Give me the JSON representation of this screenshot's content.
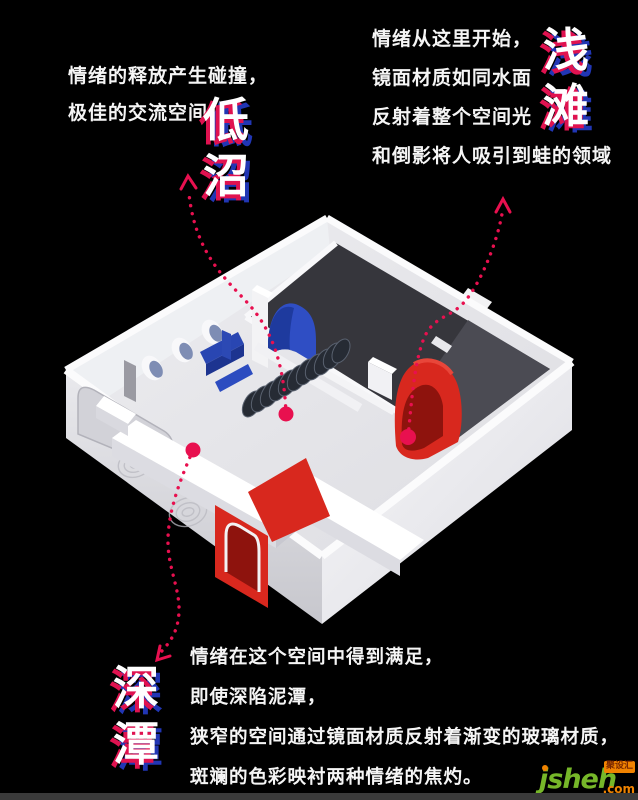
{
  "background": "#000000",
  "accent": {
    "arrow_pink": "#e8104f",
    "glitch_shadow_red": "#e01250",
    "glitch_shadow_blue": "#2136b4"
  },
  "annotations": {
    "top_left": {
      "lines": [
        "情绪的释放产生碰撞，",
        "极佳的交流空间"
      ],
      "label": "低沼"
    },
    "top_right": {
      "lines": [
        "情绪从这里开始，",
        "镜面材质如同水面",
        "反射着整个空间光",
        "和倒影将人吸引到蛙的领域"
      ],
      "label": "浅滩"
    },
    "bottom": {
      "lines": [
        "情绪在这个空间中得到满足，",
        "即使深陷泥潭，",
        "狭窄的空间通过镜面材质反射着渐变的玻璃材质，",
        "斑斓的色彩映衬两种情绪的焦灼。"
      ],
      "label": "深潭"
    }
  },
  "model": {
    "palette": {
      "wall": "#f2f2f4",
      "wall_shade": "#d8d8dd",
      "back_wall": "#ededf1",
      "floor": "#e6e6ea",
      "dark_wall": "#36363c",
      "dark_wall_light": "#4b4b53",
      "blue": "#2f4ec4",
      "blue_dark": "#1e3a9e",
      "red": "#d8281e",
      "red_dark": "#8e130d",
      "coil": "#262b34",
      "rim": "#fafafb"
    }
  },
  "watermark": {
    "brand": "jsheh",
    "suffix": ".com",
    "badge": "聚设汇",
    "green": "#76b729",
    "orange": "#f08300"
  }
}
